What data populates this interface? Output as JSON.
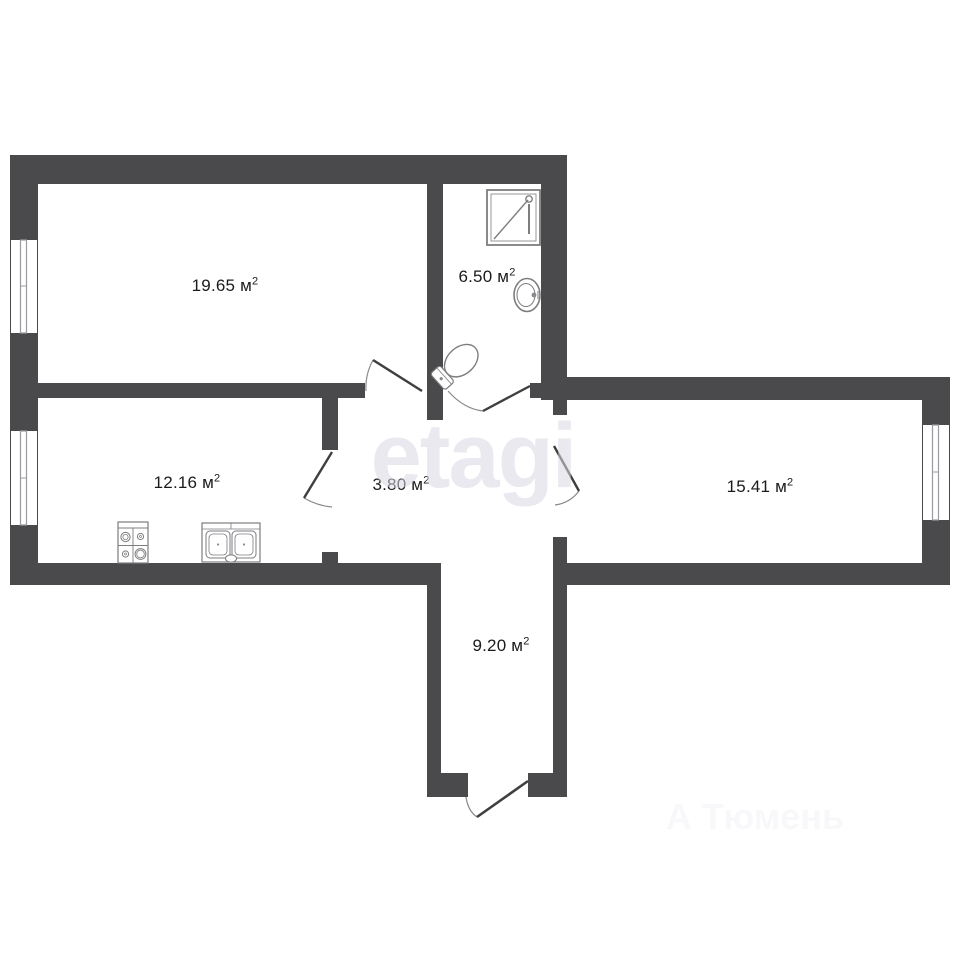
{
  "plan": {
    "type": "apartment-floor-plan",
    "rooms": [
      {
        "id": "living-room",
        "area": "19.65",
        "unit": " м",
        "sup": "2"
      },
      {
        "id": "bathroom",
        "area": "6.50",
        "unit": " м",
        "sup": "2"
      },
      {
        "id": "kitchen",
        "area": "12.16",
        "unit": " м",
        "sup": "2"
      },
      {
        "id": "hallway",
        "area": "3.80",
        "unit": " м",
        "sup": "2"
      },
      {
        "id": "room-right",
        "area": "15.41",
        "unit": " м",
        "sup": "2"
      },
      {
        "id": "corridor",
        "area": "9.20",
        "unit": " м",
        "sup": "2"
      }
    ],
    "fixtures": [
      {
        "name": "shower-icon"
      },
      {
        "name": "wash-basin-icon"
      },
      {
        "name": "toilet-icon"
      },
      {
        "name": "stove-icon"
      },
      {
        "name": "kitchen-sink-icon"
      }
    ],
    "windows_count": "3",
    "doors_count": "5"
  },
  "watermarks": {
    "center": "etagi",
    "bottom": "А Тюмень"
  },
  "colors": {
    "wall": "#4a4a4c",
    "background": "#ffffff",
    "room_fill": "#ffffff",
    "door_leaf": "#3f3f3f",
    "door_arc": "#8a8a8a",
    "fixture_line": "#7d7d80",
    "glazing_line": "#9a9aa0",
    "label_text": "#1b1b1b"
  }
}
